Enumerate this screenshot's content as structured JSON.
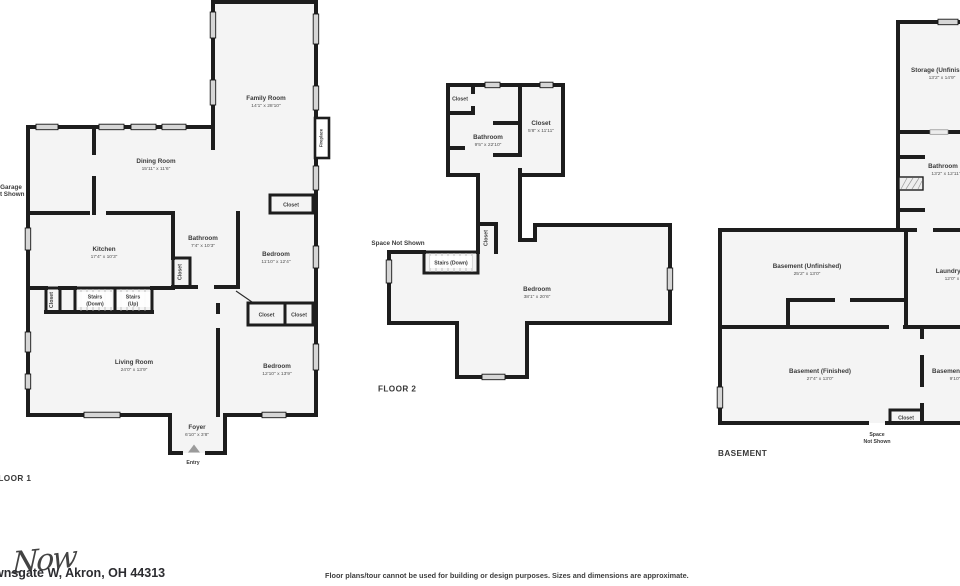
{
  "shared": {
    "closet": "Closet"
  },
  "floor1": {
    "title": "FLOOR 1",
    "family_name": "Family Room",
    "family_dims": "14'1\" x 28'10\"",
    "dining_name": "Dining Room",
    "dining_dims": "15'11\" x 11'6\"",
    "kitchen_name": "Kitchen",
    "kitchen_dims": "17'4\" x 10'3\"",
    "bath_name": "Bathroom",
    "bath_dims": "7'4\" x 10'3\"",
    "bed1_name": "Bedroom",
    "bed1_dims": "11'10\" x 12'4\"",
    "living_name": "Living Room",
    "living_dims": "24'0\" x 13'9\"",
    "bed2_name": "Bedroom",
    "bed2_dims": "12'10\" x 13'9\"",
    "foyer_name": "Foyer",
    "foyer_dims": "6'10\" x 3'8\"",
    "garage_1": "Garage",
    "garage_2": "Not Shown",
    "stairs_down_1": "Stairs",
    "stairs_down_2": "(Down)",
    "stairs_up_1": "Stairs",
    "stairs_up_2": "(Up)",
    "fireplace": "Fireplace",
    "entry": "Entry"
  },
  "floor2": {
    "title": "FLOOR 2",
    "bath_name": "Bathroom",
    "bath_dims": "9'5\" x 22'10\"",
    "closet_name": "Closet",
    "closet_dims": "5'8\" x 11'11\"",
    "bedroom_name": "Bedroom",
    "bedroom_dims": "38'1\" x 20'6\"",
    "stairs_down": "Stairs (Down)",
    "space_not_shown": "Space Not Shown"
  },
  "basement": {
    "title": "BASEMENT",
    "storage_name": "Storage (Unfinished)",
    "storage_dims": "13'2\" x 14'9\"",
    "bath_name": "Bathroom",
    "bath_dims": "13'2\" x 12'11\"",
    "unfinished_name": "Basement (Unfinished)",
    "unfinished_dims": "25'2\" x 13'0\"",
    "laundry_name": "Laundry Room",
    "laundry_dims": "12'0\" x 13'0\"",
    "finished_name": "Basement (Finished)",
    "finished_dims": "27'4\" x 13'0\"",
    "small_name": "Basement (Finished)",
    "small_dims": "9'10\" x 12'0\"",
    "space_1": "Space",
    "space_2": "Not Shown"
  },
  "footer": {
    "address": "wnsgate W, Akron, OH 44313",
    "watermark": "Now",
    "disclaimer": "Floor plans/tour cannot be used for building or design purposes. Sizes and dimensions are approximate."
  },
  "colors": {
    "wall": "#1d1d1d",
    "floor_fill": "#f4f4f4",
    "window": "#d6d6d6"
  }
}
